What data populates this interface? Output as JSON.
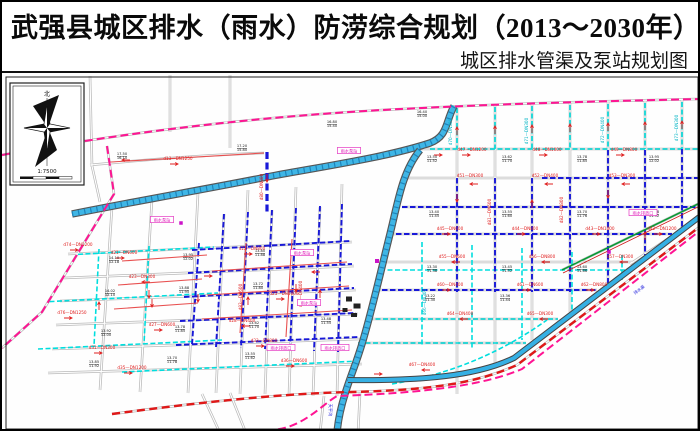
{
  "header": {
    "title": "武强县城区排水（雨水）防涝综合规划（2013～2030年）",
    "subtitle": "城区排水管渠及泵站规划图"
  },
  "compass": {
    "north_label": "北",
    "scale_text": "1:7500"
  },
  "map": {
    "colors": {
      "planning_boundary": "#ff1493",
      "road": "#b9b9b9",
      "river": "#3fb6e6",
      "planned_storm_pipe": "#00dede",
      "existing_storm_pipe": "#1818d8",
      "flow_arrow": "#e02020",
      "red_ring_road": "#e01818",
      "greenway": "#009b30"
    },
    "pipe_labels": [
      [
        470,
        149,
        "d47—DN1200"
      ],
      [
        545,
        149,
        "d48—DN1000"
      ],
      [
        622,
        149,
        "d49—DN800"
      ],
      [
        468,
        175,
        "d51—DN300"
      ],
      [
        543,
        175,
        "d52—DN400"
      ],
      [
        620,
        175,
        "d53—DN300"
      ],
      [
        448,
        228,
        "d45—DN600"
      ],
      [
        523,
        228,
        "d44—DN800"
      ],
      [
        598,
        228,
        "d43—DN1000"
      ],
      [
        660,
        228,
        "d42—DN1200"
      ],
      [
        450,
        256,
        "d55—DN600"
      ],
      [
        540,
        256,
        "d56—DN800"
      ],
      [
        618,
        256,
        "d57—DN300"
      ],
      [
        448,
        284,
        "d60—DN400"
      ],
      [
        528,
        284,
        "d61—DN600"
      ],
      [
        592,
        284,
        "d62—DN800"
      ],
      [
        458,
        313,
        "d64—DN400"
      ],
      [
        538,
        313,
        "d65—DN300"
      ],
      [
        122,
        252,
        "d21—DN600"
      ],
      [
        250,
        248,
        "d22—DN800"
      ],
      [
        140,
        276,
        "d23—DN300"
      ],
      [
        282,
        293,
        "d25—DN1000"
      ],
      [
        160,
        324,
        "d27—DN600"
      ],
      [
        240,
        320,
        "d28—DN400"
      ],
      [
        100,
        347,
        "d31—DN300"
      ],
      [
        262,
        340,
        "d33—DN800"
      ],
      [
        130,
        367,
        "d35—DN1200"
      ],
      [
        292,
        360,
        "d36—DN600"
      ],
      [
        76,
        244,
        "d74—DN1200"
      ],
      [
        70,
        312,
        "d76—DN1250"
      ],
      [
        176,
        158,
        "d13—DN1250"
      ],
      [
        420,
        364,
        "d67—DN400"
      ]
    ],
    "vertical_labels": [
      [
        450,
        130,
        "d70—DN300",
        "lc"
      ],
      [
        526,
        129,
        "d71—DN300",
        "lc"
      ],
      [
        602,
        128,
        "d72—DN400",
        "lc"
      ],
      [
        676,
        126,
        "d73—DN300",
        "lc"
      ],
      [
        489,
        210,
        "d81—DN600",
        "lr"
      ],
      [
        561,
        208,
        "d82—DN800",
        "lr"
      ],
      [
        240,
        295,
        "d83—DN600",
        "lr"
      ],
      [
        300,
        292,
        "d84—DN400",
        "lr"
      ],
      [
        261,
        185,
        "d80—DN800",
        "lr"
      ],
      [
        424,
        300,
        "d66—DN300",
        "lc"
      ]
    ],
    "elev_labels": [
      [
        430,
        157,
        "13.50|11.52"
      ],
      [
        505,
        157,
        "13.62|11.70"
      ],
      [
        580,
        157,
        "13.78|11.85"
      ],
      [
        652,
        157,
        "13.95|12.02"
      ],
      [
        432,
        212,
        "13.40|11.45"
      ],
      [
        505,
        212,
        "13.55|11.60"
      ],
      [
        580,
        212,
        "13.70|11.76"
      ],
      [
        652,
        212,
        "13.88|11.92"
      ],
      [
        430,
        267,
        "13.30|11.38"
      ],
      [
        505,
        267,
        "13.45|11.52"
      ],
      [
        580,
        267,
        "13.60|11.66"
      ],
      [
        428,
        296,
        "13.22|11.30"
      ],
      [
        503,
        296,
        "13.36|11.44"
      ],
      [
        112,
        258,
        "14.10|12.18"
      ],
      [
        186,
        255,
        "13.95|12.02"
      ],
      [
        258,
        251,
        "13.80|11.88"
      ],
      [
        108,
        291,
        "14.02|12.10"
      ],
      [
        182,
        288,
        "13.88|11.95"
      ],
      [
        256,
        284,
        "13.72|11.80"
      ],
      [
        104,
        331,
        "13.92|12.00"
      ],
      [
        178,
        327,
        "13.78|11.85"
      ],
      [
        252,
        323,
        "13.62|11.70"
      ],
      [
        324,
        319,
        "13.48|11.55"
      ],
      [
        92,
        362,
        "13.85|11.92"
      ],
      [
        170,
        358,
        "13.70|11.78"
      ],
      [
        248,
        354,
        "13.55|11.62"
      ],
      [
        120,
        154,
        "17.50|16.10"
      ],
      [
        240,
        146,
        "17.20|15.80"
      ],
      [
        330,
        122,
        "16.80|15.40"
      ],
      [
        420,
        112,
        "16.40|15.00"
      ]
    ],
    "arrows": [
      [
        468,
        153,
        0
      ],
      [
        545,
        153,
        0
      ],
      [
        622,
        153,
        0
      ],
      [
        440,
        153,
        0
      ],
      [
        468,
        182,
        180
      ],
      [
        543,
        182,
        180
      ],
      [
        620,
        182,
        180
      ],
      [
        448,
        232,
        0
      ],
      [
        523,
        232,
        0
      ],
      [
        598,
        232,
        0
      ],
      [
        660,
        232,
        0
      ],
      [
        450,
        260,
        180
      ],
      [
        540,
        260,
        180
      ],
      [
        618,
        260,
        180
      ],
      [
        448,
        288,
        0
      ],
      [
        528,
        288,
        0
      ],
      [
        592,
        288,
        0
      ],
      [
        458,
        317,
        180
      ],
      [
        538,
        317,
        180
      ],
      [
        455,
        125,
        -90
      ],
      [
        493,
        124,
        -90
      ],
      [
        530,
        123,
        -90
      ],
      [
        568,
        122,
        -90
      ],
      [
        606,
        121,
        -90
      ],
      [
        643,
        120,
        -90
      ],
      [
        680,
        119,
        -90
      ],
      [
        455,
        200,
        90
      ],
      [
        530,
        198,
        -90
      ],
      [
        606,
        196,
        90
      ],
      [
        643,
        230,
        -90
      ],
      [
        122,
        256,
        0
      ],
      [
        250,
        252,
        0
      ],
      [
        140,
        280,
        180
      ],
      [
        282,
        297,
        0
      ],
      [
        160,
        328,
        0
      ],
      [
        240,
        324,
        180
      ],
      [
        100,
        351,
        0
      ],
      [
        262,
        344,
        0
      ],
      [
        130,
        371,
        0
      ],
      [
        292,
        364,
        0
      ],
      [
        76,
        248,
        0
      ],
      [
        70,
        316,
        0
      ],
      [
        210,
        274,
        0
      ],
      [
        310,
        270,
        180
      ],
      [
        196,
        300,
        90
      ],
      [
        246,
        295,
        -90
      ],
      [
        294,
        290,
        90
      ],
      [
        318,
        288,
        -90
      ],
      [
        150,
        305,
        90
      ],
      [
        176,
        162,
        0
      ],
      [
        120,
        158,
        180
      ],
      [
        265,
        180,
        90
      ],
      [
        420,
        368,
        180
      ],
      [
        380,
        372,
        0
      ],
      [
        97,
        300,
        -90
      ],
      [
        147,
        296,
        90
      ]
    ],
    "pump_labels": [
      [
        347,
        150,
        "雨水泵站"
      ],
      [
        160,
        219,
        "雨水泵站"
      ],
      [
        300,
        252,
        "雨水泵站"
      ],
      [
        307,
        302,
        "雨水泵站"
      ],
      [
        279,
        347,
        "雨水排放口"
      ],
      [
        333,
        347,
        "雨水排放口"
      ],
      [
        641,
        212,
        "雨水排放口"
      ]
    ],
    "water_labels": [
      [
        327,
        408,
        "天平沟",
        90
      ],
      [
        638,
        289,
        "排水渠",
        -37
      ]
    ],
    "symbols": [
      [
        375,
        259,
        4,
        4,
        "ps"
      ],
      [
        607,
        250,
        3.5,
        3.5,
        "ps"
      ],
      [
        179,
        221,
        3.5,
        3.5,
        "ps"
      ],
      [
        347,
        297,
        6,
        5,
        "bld"
      ],
      [
        355,
        304,
        7,
        5,
        "bld"
      ],
      [
        343,
        308,
        5,
        4,
        "bld"
      ],
      [
        352,
        313,
        6,
        4,
        "bld"
      ]
    ]
  }
}
